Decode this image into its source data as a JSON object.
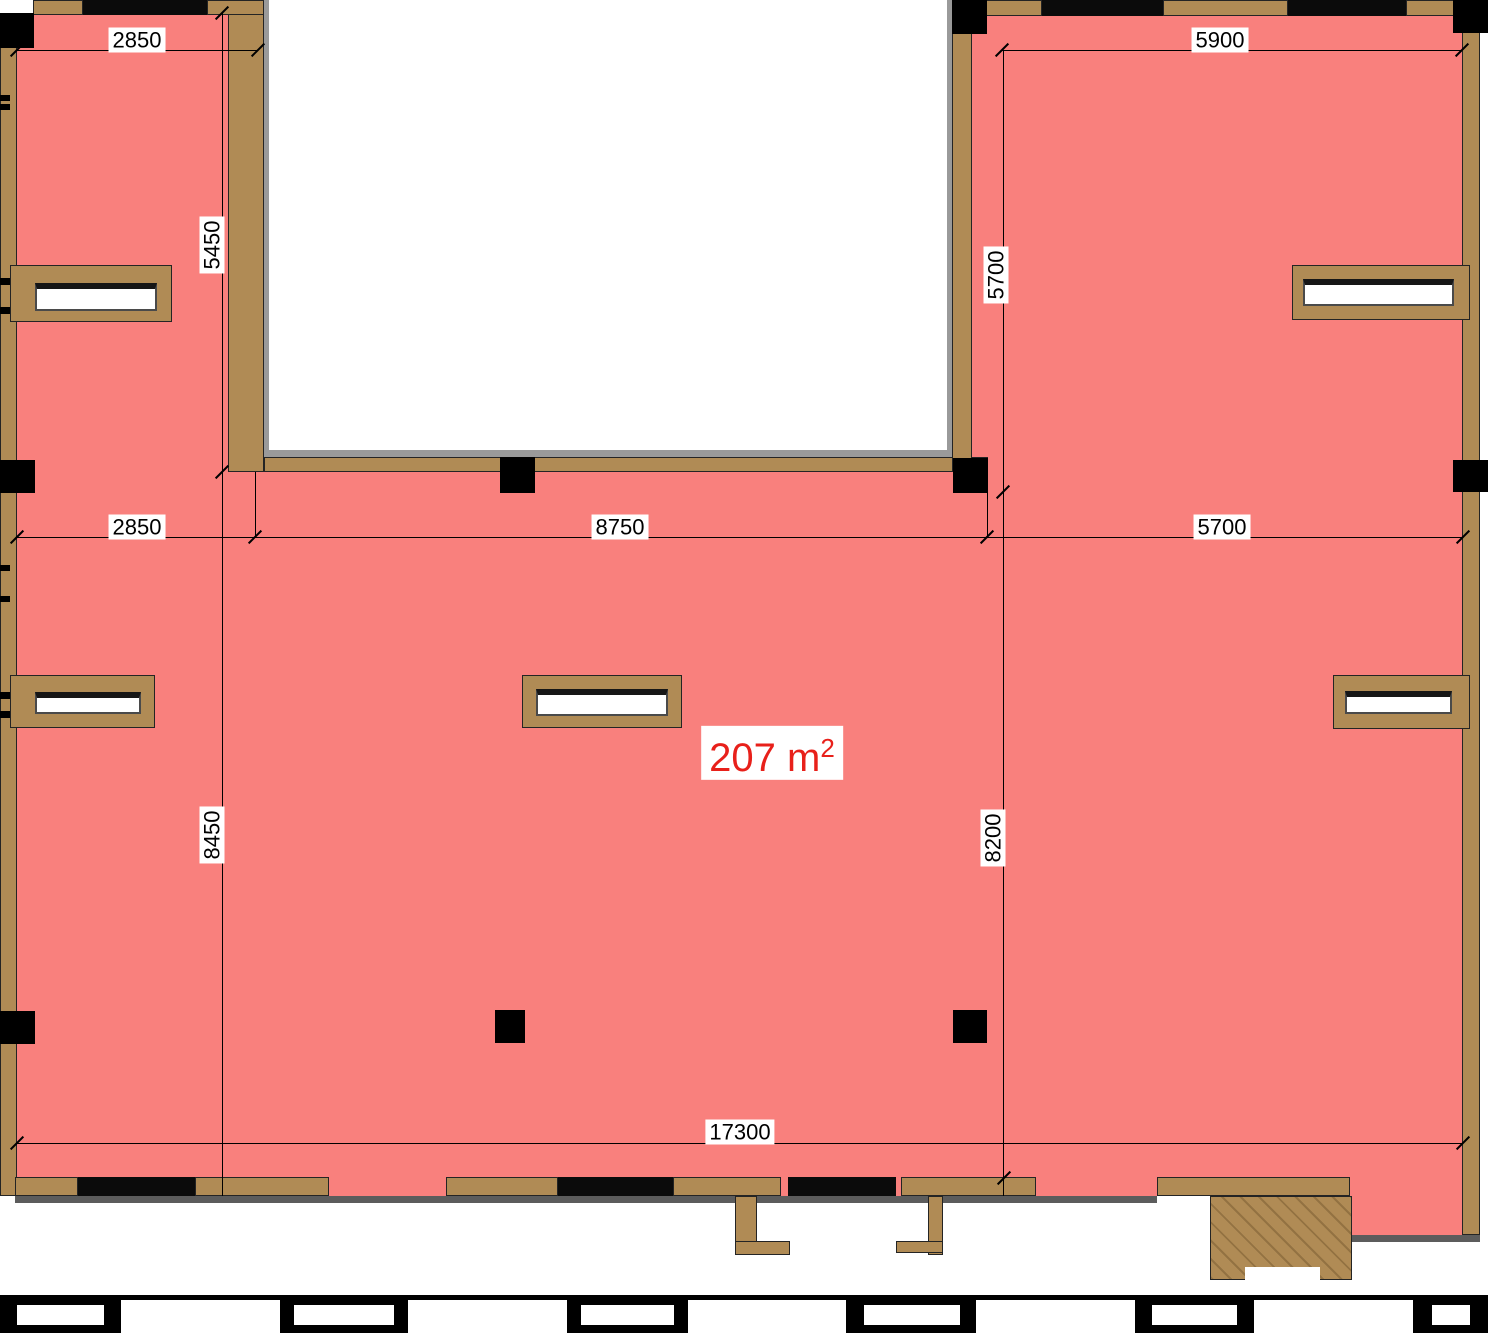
{
  "title": "Commercial space floor plan 207 m2",
  "area_label": {
    "text": "207 m",
    "sup": "2"
  },
  "dimensions": {
    "top_left_width": "2850",
    "left_wing_height": "5450",
    "top_right_width": "5900",
    "right_wing_height": "5700",
    "mid_left_width": "2850",
    "mid_center_width": "8750",
    "mid_right_width": "5700",
    "left_main_height": "8450",
    "right_main_height": "8200",
    "bottom_total_width": "17300"
  },
  "colors": {
    "floor": "#F9807D",
    "wall": "#B08B55",
    "column": "#000000",
    "area_text": "#E8201A",
    "dimension_text": "#000000"
  }
}
